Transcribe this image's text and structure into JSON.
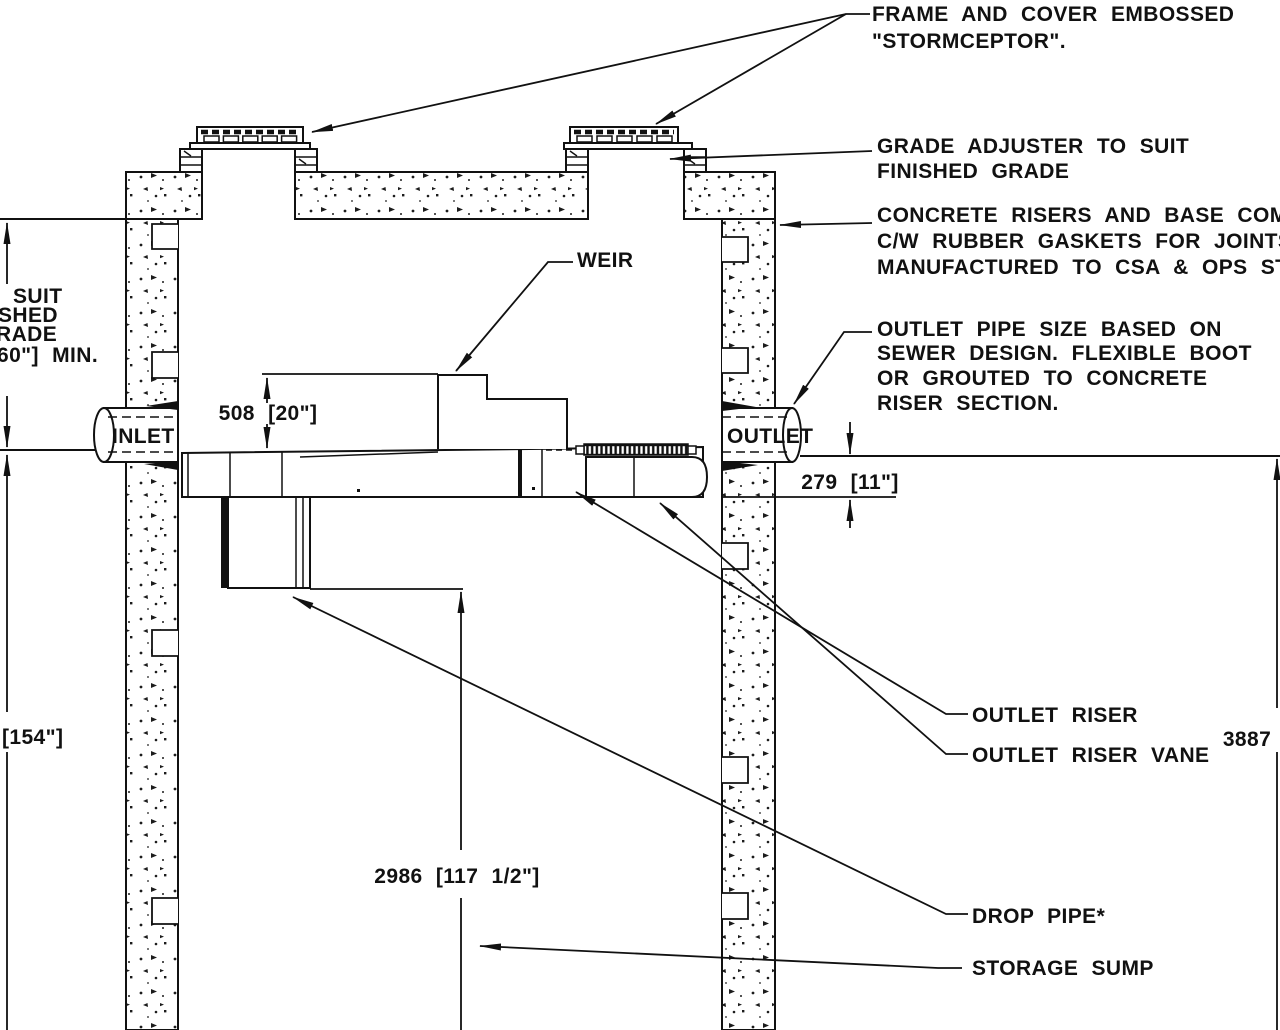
{
  "callouts": {
    "frame_cover": {
      "line1": "FRAME AND COVER EMBOSSED",
      "line2": "\"STORMCEPTOR\"."
    },
    "grade_adjuster": {
      "line1": "GRADE ADJUSTER TO SUIT",
      "line2": "FINISHED GRADE"
    },
    "concrete_risers": {
      "line1": "CONCRETE RISERS AND BASE COMPONENTS",
      "line2": "C/W RUBBER GASKETS FOR JOINTS.",
      "line3": "MANUFACTURED TO CSA & OPS STDS."
    },
    "outlet_pipe": {
      "line1": "OUTLET PIPE SIZE BASED ON",
      "line2": "SEWER DESIGN. FLEXIBLE BOOT",
      "line3": "OR GROUTED TO CONCRETE",
      "line4": "RISER SECTION."
    },
    "weir": "WEIR",
    "outlet_riser": "OUTLET RISER",
    "outlet_riser_vane": "OUTLET RISER VANE",
    "drop_pipe": "DROP PIPE*",
    "storage_sump": "STORAGE SUMP"
  },
  "pipe_labels": {
    "inlet": "INLET",
    "outlet": "OUTLET"
  },
  "dimensions": {
    "weir_drop_height": "508 [20\"]",
    "outlet_invert_drop": "279 [11\"]",
    "sump_depth": "2986 [117 1/2\"]",
    "left_depth_inches": "[154\"]",
    "overall_height_mm": "3887"
  },
  "left_margin_cutoff": {
    "line1": "SUIT",
    "line2": "SHED",
    "line3": "RADE",
    "line4": "60\"] MIN."
  },
  "colors": {
    "line": "#111111",
    "background": "#ffffff"
  }
}
